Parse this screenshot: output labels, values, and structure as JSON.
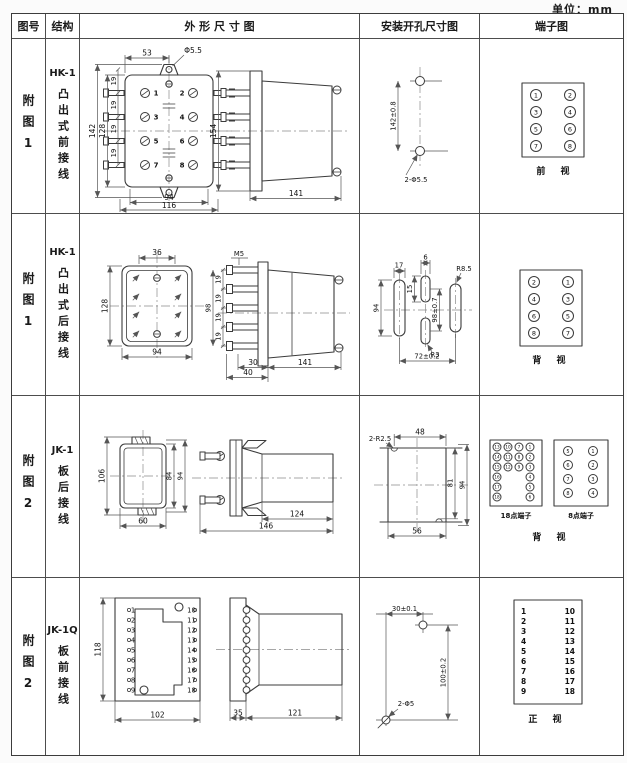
{
  "units_label": "单位：mm",
  "header": {
    "fig": "图号",
    "structure": "结构",
    "outline": "外 形 尺 寸 图",
    "install": "安装开孔尺寸图",
    "terminal": "端子图"
  },
  "rows": [
    {
      "fig": "附图1",
      "model": "HK-1",
      "structure": "凸出式前接线",
      "outline": {
        "front": {
          "w_top": "53",
          "hole": "Φ5.5",
          "h_outer": "142",
          "h_inner": "128",
          "pitch": [
            "19",
            "19",
            "19",
            "19"
          ],
          "pins": [
            "1",
            "2",
            "3",
            "4",
            "5",
            "6",
            "7",
            "8"
          ],
          "w_pins": "94",
          "w_total": "116"
        },
        "side": {
          "h": "154",
          "w": "141"
        }
      },
      "install": {
        "v": "142±0.8",
        "holes": "2-Φ5.5"
      },
      "terminal": {
        "left": [
          "1",
          "3",
          "5",
          "7"
        ],
        "right": [
          "2",
          "4",
          "6",
          "8"
        ],
        "view": "前 视"
      }
    },
    {
      "fig": "附图1",
      "model": "HK-1",
      "structure": "凸出式后接线",
      "outline": {
        "front": {
          "w_top": "36",
          "h": "128",
          "w": "94"
        },
        "side": {
          "thread": "M5",
          "h": "98",
          "pitch": [
            "19",
            "19",
            "19",
            "19"
          ],
          "d1": "30",
          "d2": "40",
          "w": "141"
        }
      },
      "install": {
        "slot_w": "17",
        "mid_w": "6",
        "mid_h": "15",
        "h_left": "94",
        "v": "98±0.7",
        "r_side": "R8.5",
        "r_mid": "R3",
        "w": "72±0.2"
      },
      "terminal": {
        "left": [
          "2",
          "4",
          "6",
          "8"
        ],
        "right": [
          "1",
          "3",
          "5",
          "7"
        ],
        "view": "背 视"
      }
    },
    {
      "fig": "附图2",
      "model": "JK-1",
      "structure": "板后接线",
      "outline": {
        "front": {
          "h": "106",
          "h_inner": "84",
          "h_outer": "94",
          "w": "60"
        },
        "side": {
          "w_body": "124",
          "w_total": "146"
        }
      },
      "install": {
        "r": "2-R2.5",
        "w_top": "48",
        "h_inner": "81",
        "h_outer": "94",
        "w_bottom": "56"
      },
      "terminal": {
        "t18": {
          "label": "18点端子",
          "cols": [
            [
              "13",
              "14",
              "15",
              "16",
              "17",
              "18"
            ],
            [
              "10",
              "11",
              "12"
            ],
            [
              "7",
              "8",
              "9"
            ],
            [
              "1",
              "2",
              "3",
              "4",
              "5",
              "6"
            ]
          ]
        },
        "t8": {
          "label": "8点端子",
          "left": [
            "5",
            "6",
            "7",
            "8"
          ],
          "right": [
            "1",
            "2",
            "3",
            "4"
          ]
        },
        "view": "背 视"
      }
    },
    {
      "fig": "附图2",
      "model": "JK-1Q",
      "structure": "板前接线",
      "outline": {
        "front": {
          "h": "118",
          "w": "102",
          "left_pins": [
            "1",
            "2",
            "3",
            "4",
            "5",
            "6",
            "7",
            "8",
            "9"
          ],
          "right_pins": [
            "10",
            "11",
            "12",
            "13",
            "14",
            "15",
            "16",
            "17",
            "18"
          ]
        },
        "side": {
          "w_flange": "35",
          "w_body": "121"
        }
      },
      "install": {
        "w": "30±0.1",
        "h": "100±0.2",
        "holes": "2-Φ5"
      },
      "terminal": {
        "left": [
          "1",
          "2",
          "3",
          "4",
          "5",
          "6",
          "7",
          "8",
          "9"
        ],
        "right": [
          "10",
          "11",
          "12",
          "13",
          "14",
          "15",
          "16",
          "17",
          "18"
        ],
        "view": "正 视"
      }
    }
  ]
}
